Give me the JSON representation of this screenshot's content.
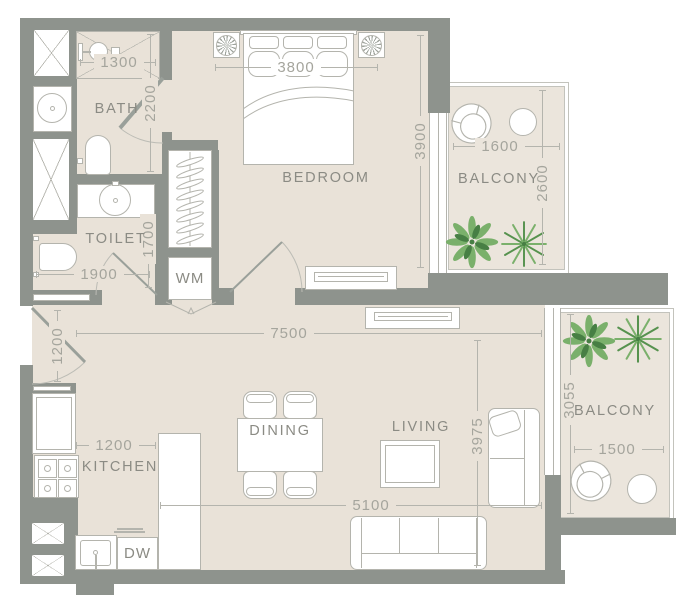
{
  "floorplan": {
    "rooms": {
      "bath": "BATH",
      "toilet": "TOILET",
      "bedroom": "BEDROOM",
      "balcony_top": "BALCONY",
      "kitchen": "KITCHEN",
      "dining": "DINING",
      "living": "LIVING",
      "balcony_right": "BALCONY"
    },
    "appliances": {
      "washing_machine": "WM",
      "dishwasher": "DW"
    },
    "dimensions_mm": {
      "shower_width": "1300",
      "bath_depth": "2200",
      "bed_width": "3800",
      "bedroom_depth": "3900",
      "balcony_top_width": "1600",
      "balcony_top_depth": "2600",
      "toilet_depth": "1700",
      "toilet_width": "1900",
      "entry_width": "1200",
      "living_total_width": "7500",
      "kitchen_width": "1200",
      "living_depth": "3975",
      "living_width": "5100",
      "balcony_right_depth": "3055",
      "balcony_right_width": "1500"
    },
    "colors": {
      "wall": "#8e938d",
      "floor": "#e9e2d8",
      "balcony_floor": "#ebe5dc",
      "plant_dark": "#477f44",
      "plant_light": "#7ab06b"
    }
  }
}
